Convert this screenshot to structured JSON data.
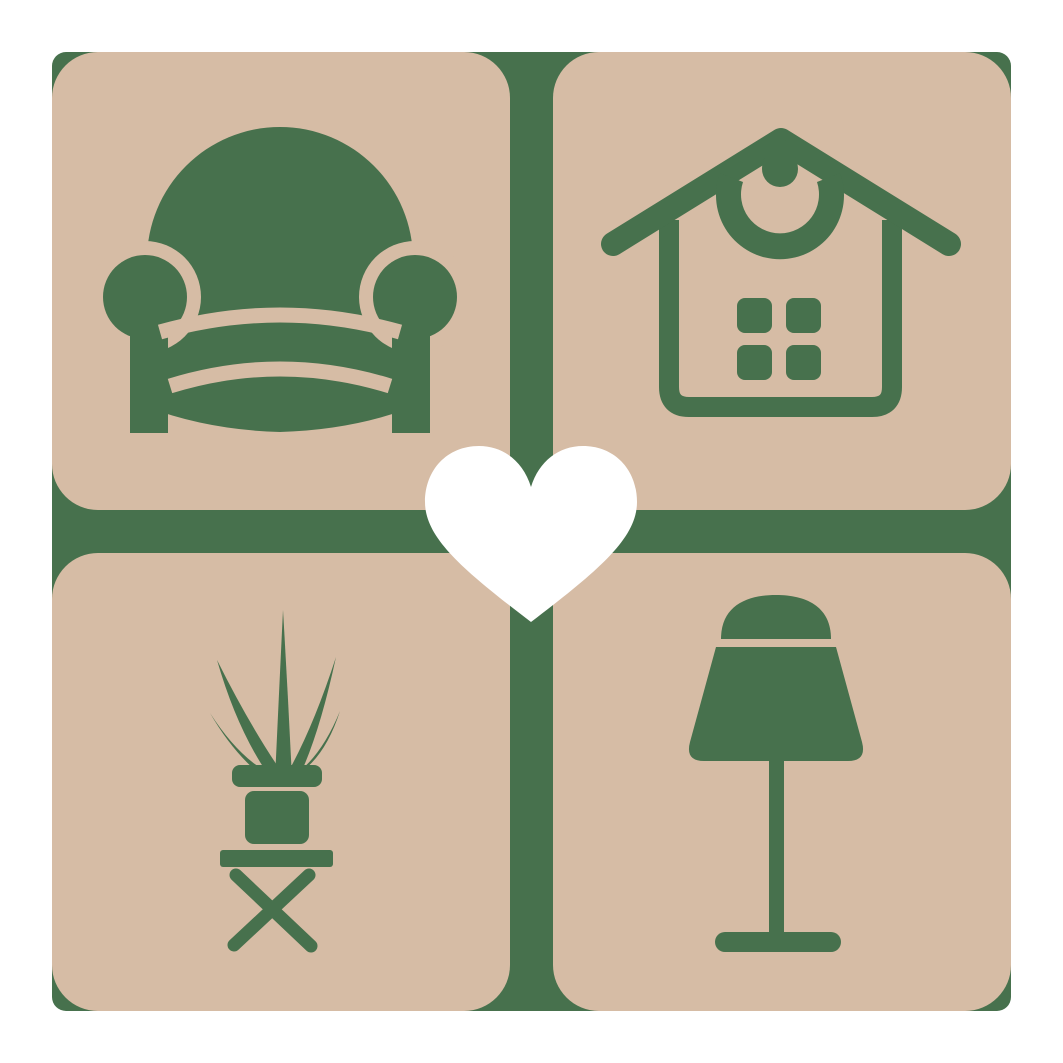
{
  "logo": {
    "grid": {
      "rows": 2,
      "cols": 2
    },
    "tiles": [
      {
        "position": "top-left",
        "icon": "armchair-icon"
      },
      {
        "position": "top-right",
        "icon": "house-icon"
      },
      {
        "position": "bottom-left",
        "icon": "potted-plant-icon"
      },
      {
        "position": "bottom-right",
        "icon": "table-lamp-icon"
      }
    ],
    "center_icon": "heart-icon"
  },
  "colors": {
    "page_background": "#ffffff",
    "backdrop_green": "#47714d",
    "icon_green": "#47714d",
    "tile_tan": "#d6bca5",
    "heart_white": "#ffffff"
  }
}
